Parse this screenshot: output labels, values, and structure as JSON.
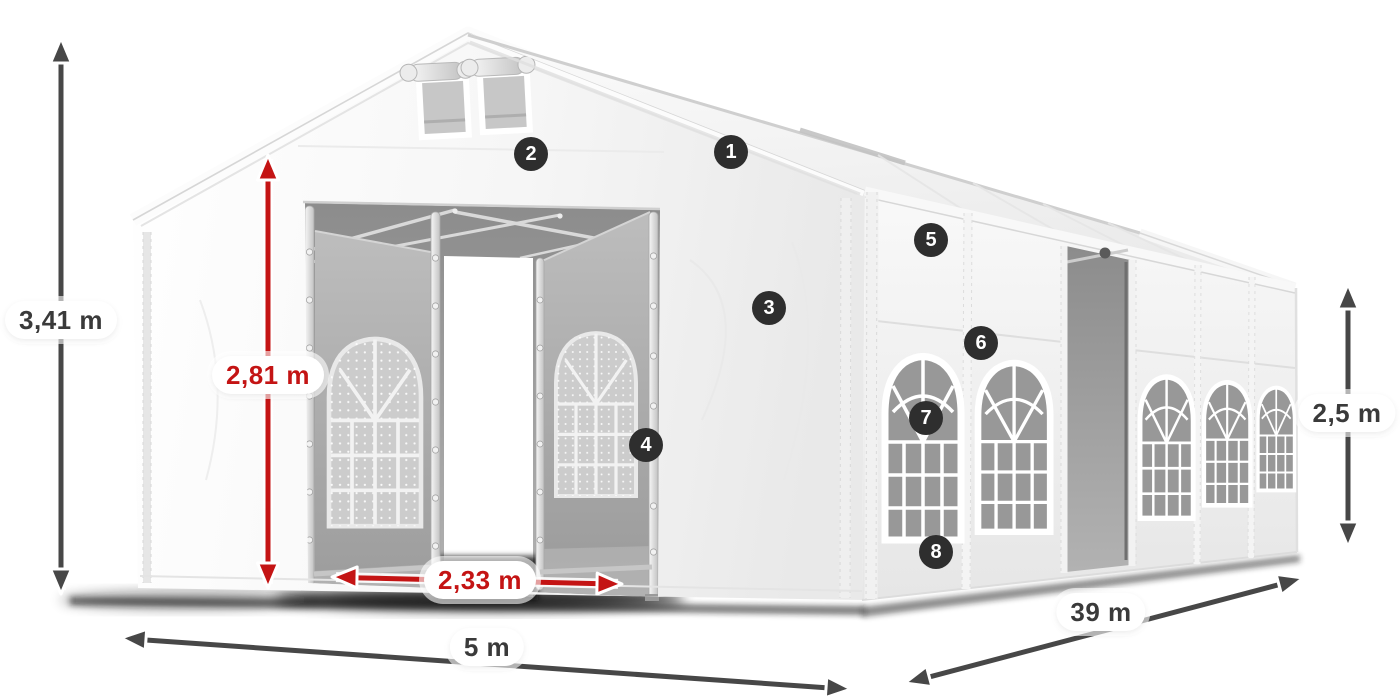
{
  "dimensions": [
    {
      "id": "total-height",
      "label": "3,41 m",
      "style": "gray"
    },
    {
      "id": "entrance-height",
      "label": "2,81 m",
      "style": "red"
    },
    {
      "id": "entrance-width",
      "label": "2,33 m",
      "style": "red"
    },
    {
      "id": "gable-width",
      "label": "5 m",
      "style": "gray"
    },
    {
      "id": "side-length",
      "label": "39 m",
      "style": "gray"
    },
    {
      "id": "side-height",
      "label": "2,5 m",
      "style": "gray"
    }
  ],
  "markers": [
    {
      "number": "1"
    },
    {
      "number": "2"
    },
    {
      "number": "3"
    },
    {
      "number": "4"
    },
    {
      "number": "5"
    },
    {
      "number": "6"
    },
    {
      "number": "7"
    },
    {
      "number": "8"
    }
  ],
  "colors": {
    "red_accent": "#c41414",
    "dimension_gray": "#474747",
    "marker_background": "#2e2e2e",
    "marker_text": "#ffffff",
    "label_background": "#ffffff",
    "label_text": "#3a3a3a",
    "page_background": "#ffffff"
  }
}
